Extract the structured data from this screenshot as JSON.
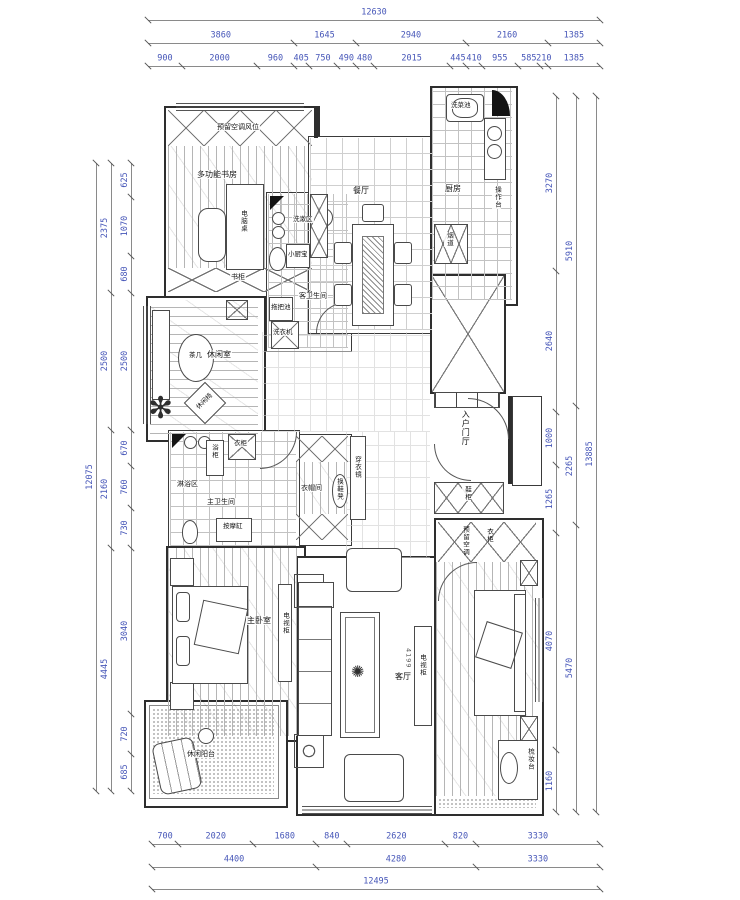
{
  "drawing": {
    "dimensions": {
      "top_overall": [
        "12630"
      ],
      "top_row2": [
        "3860",
        "1645",
        "2940",
        "2160",
        "1385"
      ],
      "top_row3": [
        "900",
        "2000",
        "960",
        "405",
        "750",
        "490",
        "480",
        "2015",
        "445",
        "410",
        "955",
        "585",
        "210",
        "1385"
      ],
      "bottom_row1": [
        "700",
        "2020",
        "1680",
        "840",
        "2620",
        "820",
        "3330"
      ],
      "bottom_row2": [
        "4400",
        "4280",
        "3330"
      ],
      "bottom_overall": [
        "12495"
      ],
      "left_inner": [
        "625",
        "1070",
        "680",
        "2500",
        "670",
        "760",
        "730",
        "3040",
        "720",
        "685"
      ],
      "left_mid": [
        "2375",
        "2500",
        "2160",
        "4445"
      ],
      "left_overall": [
        "12075"
      ],
      "right_inner": [
        "3270",
        "2640",
        "1000",
        "1265",
        "4070",
        "1160"
      ],
      "right_mid": [
        "5910",
        "2265",
        "5470"
      ],
      "right_overall": [
        "13885"
      ]
    },
    "rooms": {
      "study": {
        "name": "多功能书房",
        "ac_band": "预留空调风位",
        "desk": "电脑桌",
        "bookcase": "书柜"
      },
      "leisure": {
        "name": "休闲室",
        "tea_table": "茶几",
        "chair": "休闲椅"
      },
      "guest_bath": {
        "name": "客卫生间",
        "wash_area": "洗漱区",
        "water_heater": "小厨宝",
        "mop_pool": "拖把池",
        "washer": "洗衣机"
      },
      "dining": {
        "name": "餐厅"
      },
      "kitchen": {
        "name": "厨房",
        "sink": "洗菜池",
        "counter": "操作台",
        "flue": "烟道"
      },
      "entry": {
        "name": "入户门厅",
        "shoe_cabinet": "鞋柜"
      },
      "closet": {
        "name": "衣帽间",
        "mirror": "穿衣镜",
        "bench": "换鞋凳"
      },
      "master_bath": {
        "name": "主卫生间",
        "shower": "淋浴区",
        "cabinet": "浴柜",
        "tub": "按摩缸",
        "wardrobe": "衣柜"
      },
      "master_bedroom": {
        "name": "主卧室",
        "tv_cabinet": "电视柜"
      },
      "living": {
        "name": "客厅",
        "tv_cabinet": "电视柜",
        "tv_wall_dim": "4199"
      },
      "balcony": {
        "name": "休闲阳台"
      },
      "bedroom2": {
        "wardrobe": "衣柜",
        "reserved": "预留空调",
        "dresser": "梳妆台"
      }
    }
  }
}
